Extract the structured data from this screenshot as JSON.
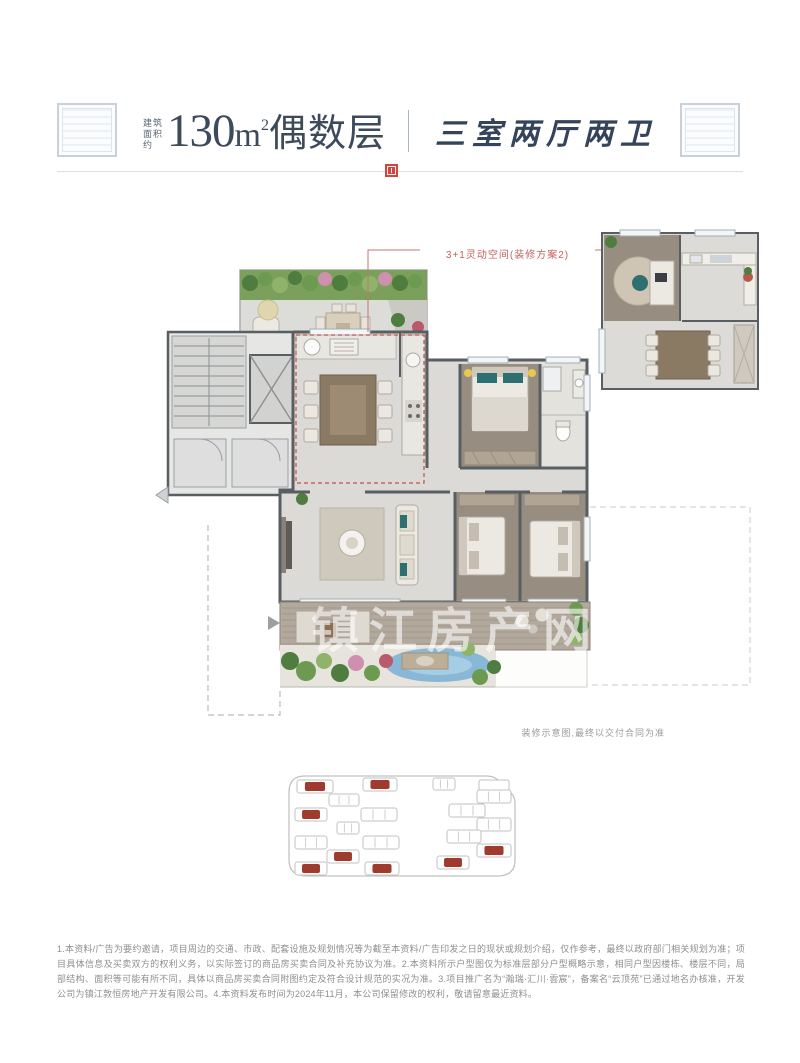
{
  "header": {
    "area_prefix": "建筑面积约",
    "area_value": "130",
    "area_unit": "m",
    "area_sup": "2",
    "floor_type": "偶数层",
    "layout_name": "三室两厅两卫"
  },
  "floor_plan": {
    "annotation": "3+1灵动空间(装修方案2)",
    "note": "装修示意图,最终以交付合同为准",
    "watermark": "镇江房产网"
  },
  "site_plan": {
    "outline_color": "#c2c2c2",
    "highlight_color": "#9e3a2e",
    "buildings": [
      {
        "x": 16,
        "y": 20,
        "w": 36,
        "h": 13,
        "hl": true
      },
      {
        "x": 82,
        "y": 18,
        "w": 34,
        "h": 13,
        "hl": true
      },
      {
        "x": 152,
        "y": 18,
        "w": 22,
        "h": 12,
        "hl": false
      },
      {
        "x": 196,
        "y": 30,
        "w": 34,
        "h": 13,
        "hl": false
      },
      {
        "x": 48,
        "y": 34,
        "w": 30,
        "h": 12,
        "hl": false
      },
      {
        "x": 14,
        "y": 48,
        "w": 32,
        "h": 13,
        "hl": true
      },
      {
        "x": 80,
        "y": 48,
        "w": 36,
        "h": 13,
        "hl": false
      },
      {
        "x": 168,
        "y": 44,
        "w": 36,
        "h": 13,
        "hl": false
      },
      {
        "x": 56,
        "y": 62,
        "w": 22,
        "h": 12,
        "hl": false
      },
      {
        "x": 196,
        "y": 58,
        "w": 34,
        "h": 13,
        "hl": false
      },
      {
        "x": 14,
        "y": 76,
        "w": 32,
        "h": 13,
        "hl": false
      },
      {
        "x": 82,
        "y": 76,
        "w": 36,
        "h": 13,
        "hl": false
      },
      {
        "x": 166,
        "y": 70,
        "w": 34,
        "h": 13,
        "hl": false
      },
      {
        "x": 196,
        "y": 84,
        "w": 34,
        "h": 13,
        "hl": true
      },
      {
        "x": 46,
        "y": 90,
        "w": 32,
        "h": 13,
        "hl": true
      },
      {
        "x": 14,
        "y": 102,
        "w": 32,
        "h": 13,
        "hl": true
      },
      {
        "x": 84,
        "y": 102,
        "w": 34,
        "h": 13,
        "hl": true
      },
      {
        "x": 156,
        "y": 96,
        "w": 32,
        "h": 13,
        "hl": true
      }
    ]
  },
  "disclaimer": "1.本资料/广告为要约邀请，项目周边的交通、市政、配套设施及规划情况等为截至本资料/广告印发之日的现状或规划介绍，仅作参考，最终以政府部门相关规划为准；项目具体信息及买卖双方的权利义务，以实际签订的商品房买卖合同及补充协议为准。2.本资料所示户型图仅为标准层部分户型概略示意，相同户型因楼栋、楼层不同，局部结构、面积等可能有所不同，具体以商品房买卖合同附图约定及符合设计规范的实况为准。3.项目推广名为“瀚瑞·汇川·雲宸”，备案名“云顶苑”已通过地名办核准，开发公司为镇江敦恒房地产开发有限公司。4.本资料发布时间为2024年11月，本公司保留修改的权利，敬请留意最近资料。"
}
